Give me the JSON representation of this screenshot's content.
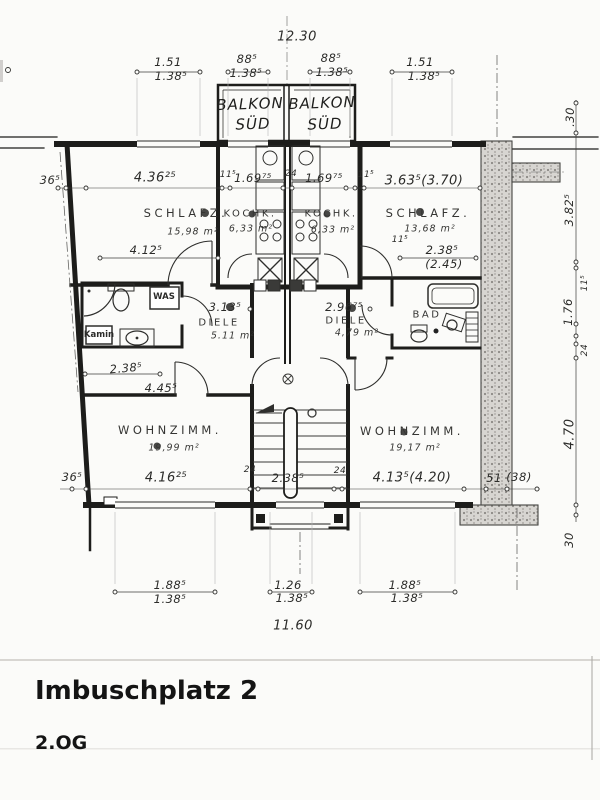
{
  "title": {
    "building": "Imbuschplatz 2",
    "floor": "2.OG"
  },
  "balcony_left": {
    "line1": "BALKON",
    "line2": "SÜD"
  },
  "balcony_right": {
    "line1": "BALKON",
    "line2": "SÜD"
  },
  "rooms": {
    "schlafzimmer_left": {
      "name": "SCHLAFZ.",
      "area": "15,98 m²"
    },
    "kochkueche_left": {
      "name": "KOCHK.",
      "area": "6,33 m²"
    },
    "kochkueche_right": {
      "name": "KOCHK.",
      "area": "6,33 m²"
    },
    "schlafzimmer_right": {
      "name": "SCHLAFZ.",
      "area": "13,68 m²"
    },
    "diele_left": {
      "name": "DIELE",
      "area": "5.11 m²"
    },
    "diele_right": {
      "name": "DIELE",
      "area": "4,79 m²"
    },
    "bad": {
      "name": "BAD"
    },
    "wohnzimmer_left": {
      "name": "WOHNZIMM.",
      "area": "19,99 m²"
    },
    "wohnzimmer_right": {
      "name": "WOHNZIMM.",
      "area": "19,17 m²"
    }
  },
  "fixtures": {
    "washing_machine": "WAS",
    "chimney": "Kamin"
  },
  "dims": {
    "top_total": "12.30",
    "top_win_left": {
      "upper": "1.51",
      "lower": "1.38⁵"
    },
    "top_balc_left": {
      "upper": "88⁵",
      "lower": "1.38⁵"
    },
    "top_balc_right": {
      "upper": "88⁵",
      "lower": "1.38⁵"
    },
    "top_win_right": {
      "upper": "1.51",
      "lower": "1.38⁵"
    },
    "left_wall_top": "36⁵",
    "schlafz_l_width": "4.36²⁵",
    "wall_11_a": "11⁵",
    "kochk_l_width": "1.69⁷⁵",
    "wall_24_top": "24",
    "kochk_r_width": "1.69⁷⁵",
    "wall_11_b": "11⁵",
    "schlafz_r_width": "3.63⁵(3.70)",
    "schlafz_l_inner": "4.12⁵",
    "wall_11_c": "11⁵",
    "bad_width": "2.38⁵",
    "bad_width_alt": "(2.45)",
    "diele_l_width": "3.13⁵",
    "diele_r_width": "2.96⁷⁵",
    "bath_l_width": "2.38⁵",
    "wohnz_l_top_width": "4.45⁵",
    "left_wall_bottom": "36⁵",
    "wohnz_l_width": "4.16²⁵",
    "stair_wall_left": "24",
    "stair_width": "2.38⁵",
    "stair_wall_right": "24",
    "wohnz_r_width": "4.13⁵(4.20)",
    "wall_51": "51",
    "wall_38": "(38)",
    "right_30_top": ".30",
    "right_schlafz_depth": "3.82⁵",
    "right_11": "11⁵",
    "right_bad_depth": "1.76",
    "right_24": "24",
    "right_wohnz_depth": "4.70",
    "right_30_bottom": "30",
    "bottom_win_left": {
      "upper": "1.88⁵",
      "lower": "1.38⁵"
    },
    "bottom_win_mid": {
      "upper": "1.26",
      "lower": "1.38⁵"
    },
    "bottom_win_right": {
      "upper": "1.88⁵",
      "lower": "1.38⁵"
    },
    "bottom_total": "11.60"
  }
}
